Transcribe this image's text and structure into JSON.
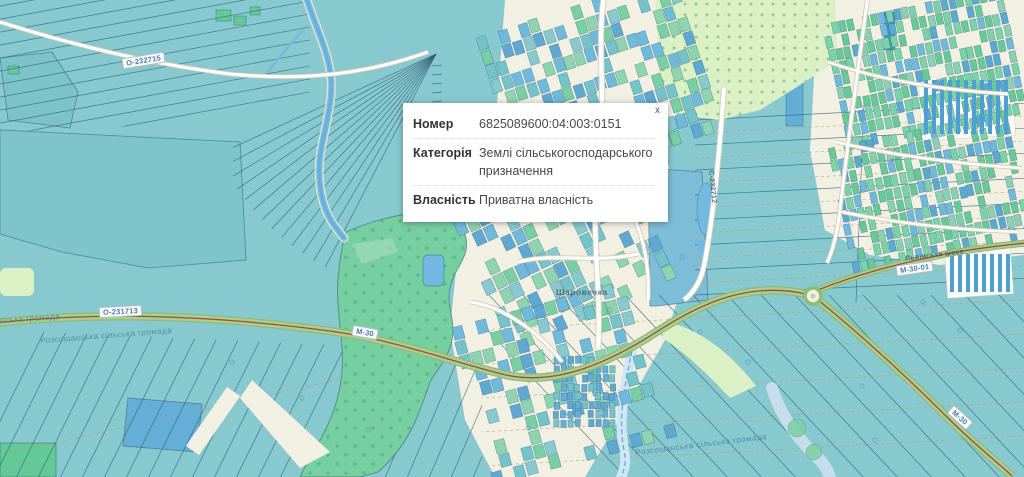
{
  "popup": {
    "close_label": "x",
    "rows": [
      {
        "label": "Номер",
        "value": "6825089600:04:003:0151"
      },
      {
        "label": "Категорія",
        "value": "Землі сільськогосподарського призначення"
      },
      {
        "label": "Власність",
        "value": "Приватна власність"
      }
    ]
  },
  "map": {
    "road_badges": {
      "o232715": "О-232715",
      "o231713": "О-231713",
      "m30_west": "М-30",
      "m30_01": "М-30-01",
      "m30_east": "М-30"
    },
    "road_names": {
      "c232712": "С-232712",
      "lvivske_shose": "Львівське шосе"
    },
    "place_labels": {
      "village": "Шаровечка"
    },
    "boundary_labels": {
      "hromada_city": "Хмельницька міська громада",
      "hromada_rural_west": "Розсошанська сільська громада",
      "hromada_rural_east": "Розсошанська сільська громада"
    },
    "colors": {
      "land_teal": "#87c9cf",
      "bg_cream": "#f2efe3",
      "parcel_line": "#2e5d70",
      "parcel_blue": "#64aed8",
      "parcel_green": "#63c997",
      "forest_green": "#76cfa0",
      "pale_green": "#dcf0c6",
      "water_blue": "#74b9e2",
      "road_white": "#ffffff",
      "road_casing": "#d6cdb8",
      "highway_green": "#a6cf90",
      "highway_center": "#a34b3b",
      "badge_text": "#4a7ab8",
      "boundary_text": "#4a7d96"
    }
  }
}
